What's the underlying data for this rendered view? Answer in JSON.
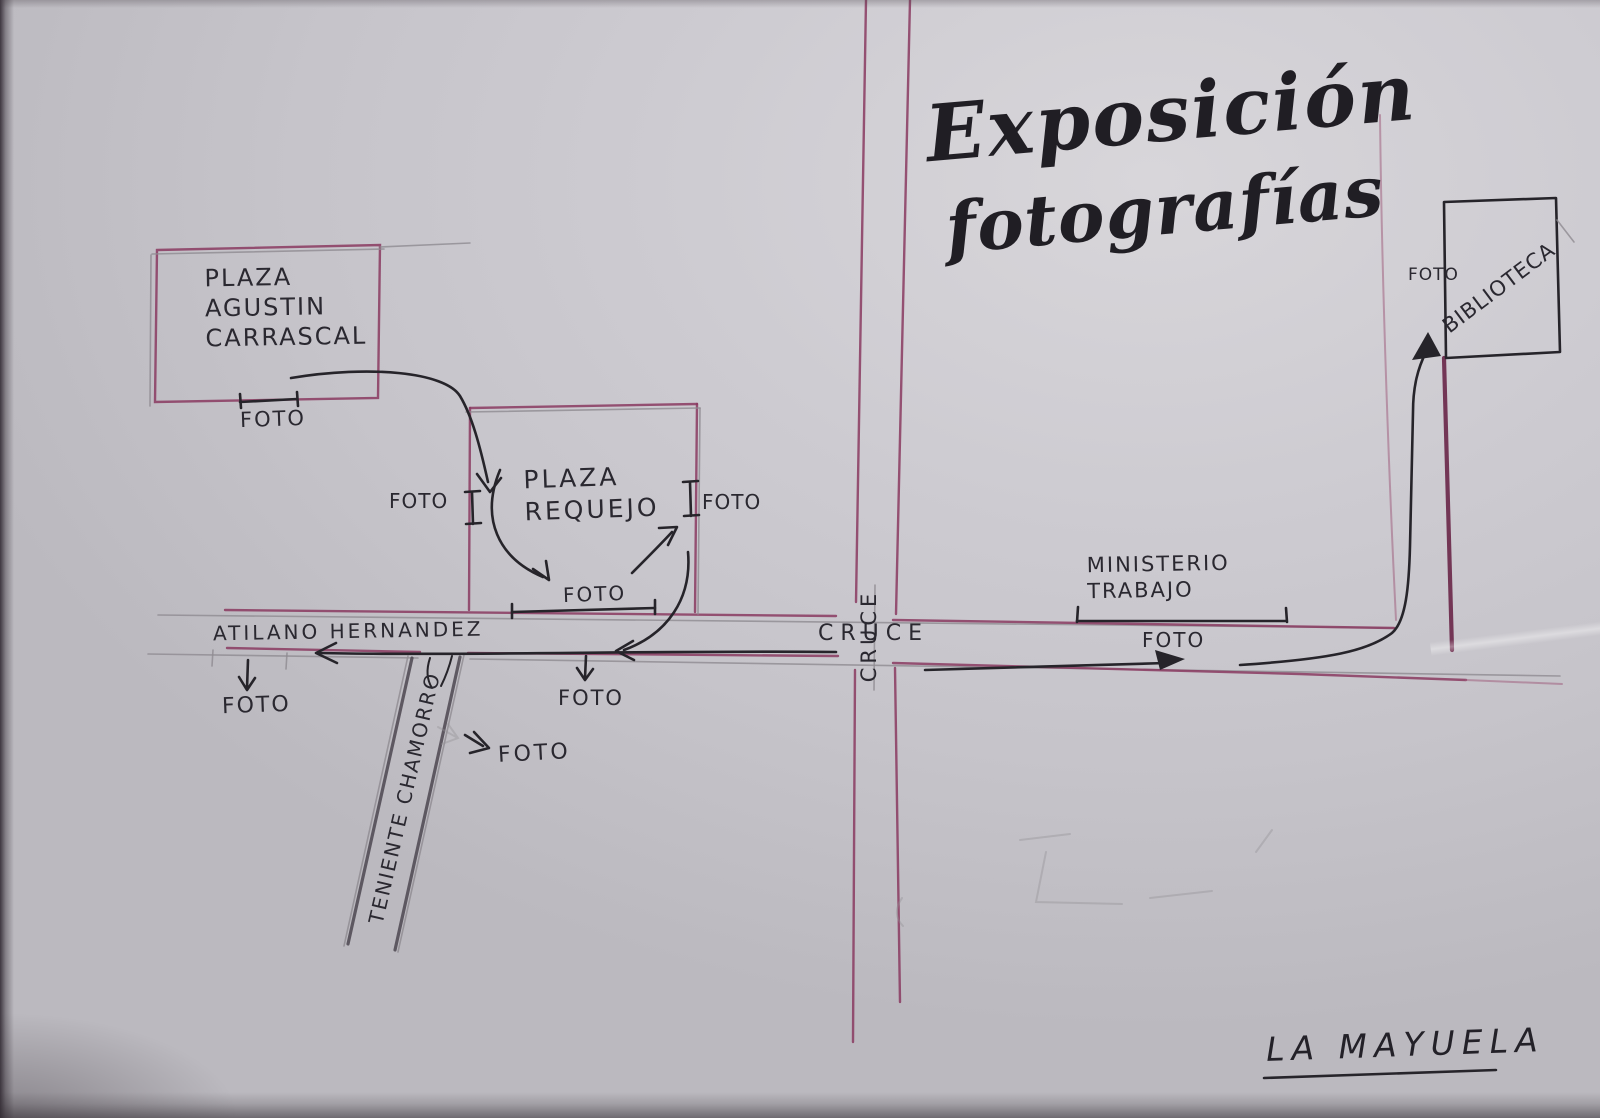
{
  "colors": {
    "paper": "#cac8ce",
    "ink": "#26242a",
    "street_purple": "#8a3a60",
    "street_purple_dark": "#672144",
    "street_purple_light": "#a06080",
    "pencil": "#8e8b91"
  },
  "title": {
    "line1": "Exposición",
    "line2": "fotografías"
  },
  "places": {
    "plaza_carrascal": "PLAZA\nAGUSTIN\nCARRASCAL",
    "plaza_requejo": "PLAZA\nREQUEJO",
    "ministerio_trabajo": "MINISTERIO\nTRABAJO",
    "biblioteca": "BIBLIOTECA"
  },
  "streets": {
    "atilano_hernandez": "ATILANO HERNANDEZ",
    "teniente_chamorro": "TENIENTE CHAMORRO",
    "cruce_horizontal": "CRUCE",
    "cruce_vertical": "CRUCE"
  },
  "photo_spots": {
    "carrascal": "FOTO",
    "requejo_left": "FOTO",
    "requejo_right": "FOTO",
    "requejo_bottom": "FOTO",
    "atilano_left": "FOTO",
    "atilano_mid": "FOTO",
    "teniente": "FOTO",
    "ministerio": "FOTO",
    "biblioteca": "FOTO"
  },
  "signature": "LA MAYUELA"
}
